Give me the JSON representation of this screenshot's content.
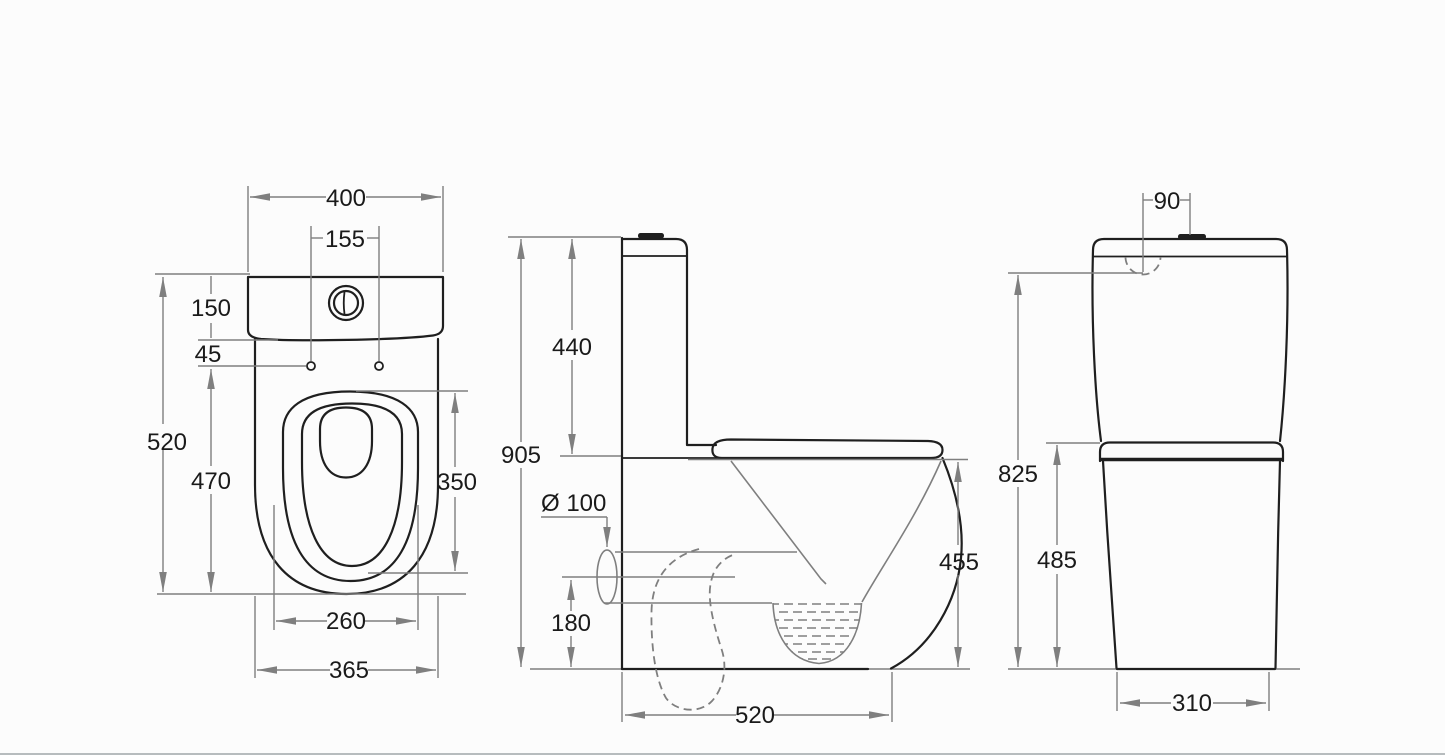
{
  "drawing": {
    "type": "technical-dimension-drawing",
    "subject": "close-coupled toilet suite, three orthographic views",
    "colors": {
      "object_line": "#1f1f1f",
      "dimension_line": "#7f7f7f",
      "text": "#1a1a1a",
      "background": "#fcfcfc"
    },
    "units": "mm"
  },
  "views": {
    "top": {
      "label": "plan view",
      "dims": {
        "overall_width": "400",
        "button_hole_spacing": "155",
        "cistern_depth": "150",
        "fixing_hole_offset": "45",
        "overall_depth": "520",
        "fixing_hole_to_front": "470",
        "seat_cutout_length": "350",
        "seat_cutout_width": "260",
        "bowl_width": "365"
      }
    },
    "side": {
      "label": "side view",
      "dims": {
        "overall_height": "905",
        "cistern_height": "440",
        "outlet_diameter": "Ø 100",
        "outlet_centre_height": "180",
        "bowl_height": "455",
        "base_depth": "520"
      }
    },
    "rear": {
      "label": "rear view",
      "dims": {
        "inlet_offset": "90",
        "shoulder_height": "825",
        "seat_height": "485",
        "base_width": "310"
      }
    }
  }
}
